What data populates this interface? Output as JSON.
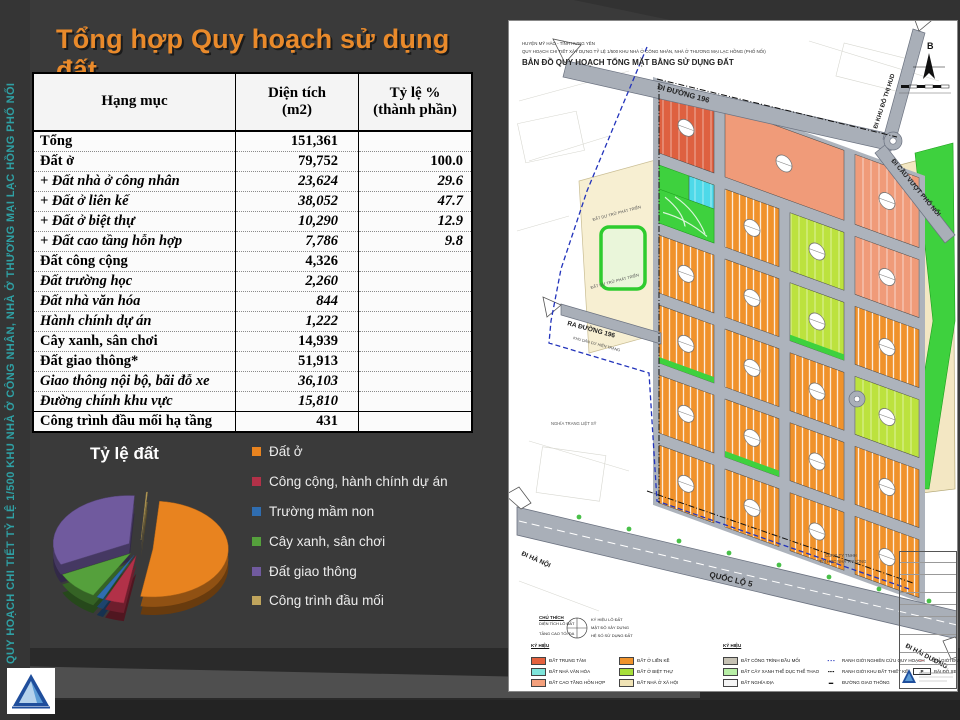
{
  "slide": {
    "title": "Tổng hợp Quy hoạch sử dụng đất",
    "sidebar_text": "QUY HOẠCH CHI TIẾT TỶ LỆ 1/500 KHU NHÀ Ở CÔNG NHÂN, NHÀ Ở THƯƠNG MẠI LẠC HỒNG PHỐ NỐI"
  },
  "table": {
    "headers": [
      {
        "line1": "Hạng mục",
        "line2": ""
      },
      {
        "line1": "Diện tích",
        "line2": "(m2)"
      },
      {
        "line1": "Tỷ lệ %",
        "line2": "(thành phần)"
      }
    ],
    "rows": [
      {
        "label": "Tổng",
        "area": "151,361",
        "pct": "",
        "style": "bold"
      },
      {
        "label": "Đất ở",
        "area": "79,752",
        "pct": "100.0",
        "style": "bold"
      },
      {
        "label": "+ Đất nhà ở công nhân",
        "area": "23,624",
        "pct": "29.6",
        "style": "sub"
      },
      {
        "label": "+ Đất ở liên kế",
        "area": "38,052",
        "pct": "47.7",
        "style": "sub"
      },
      {
        "label": "+ Đất ở biệt thự",
        "area": "10,290",
        "pct": "12.9",
        "style": "sub"
      },
      {
        "label": "+ Đất cao tầng hỗn hợp",
        "area": "7,786",
        "pct": "9.8",
        "style": "sub"
      },
      {
        "label": "Đất công cộng",
        "area": "4,326",
        "pct": "",
        "style": "bold"
      },
      {
        "label": "Đất trường học",
        "area": "2,260",
        "pct": "",
        "style": "sub"
      },
      {
        "label": "Đất nhà văn hóa",
        "area": "844",
        "pct": "",
        "style": "sub"
      },
      {
        "label": "Hành chính dự án",
        "area": "1,222",
        "pct": "",
        "style": "sub"
      },
      {
        "label": "Cây xanh, sân chơi",
        "area": "14,939",
        "pct": "",
        "style": "bold"
      },
      {
        "label": "Đất giao thông*",
        "area": "51,913",
        "pct": "",
        "style": "bold"
      },
      {
        "label": "Giao thông nội bộ, bãi đỗ xe",
        "area": "36,103",
        "pct": "",
        "style": "sub"
      },
      {
        "label": "Đường chính khu vực",
        "area": "15,810",
        "pct": "",
        "style": "sub"
      },
      {
        "label": "Công trình đầu mối hạ tầng",
        "area": "431",
        "pct": "",
        "style": "bold final"
      }
    ]
  },
  "chart_data": {
    "type": "pie",
    "style": "3d-exploded",
    "title": "Tỷ lệ đất",
    "labels": [
      "Đất ở",
      "Công cộng, hành chính dự án",
      "Trường mầm non",
      "Cây xanh, sân chơi",
      "Đất giao thông",
      "Công trình đầu mối"
    ],
    "values": [
      79752,
      6392,
      2260,
      14939,
      51913,
      431
    ],
    "colors": [
      "#E8831F",
      "#B23148",
      "#2F6DB0",
      "#55A03C",
      "#705A9E",
      "#BFA45C"
    ],
    "legend_position": "right"
  },
  "map": {
    "title_line1": "HUYỆN MỸ HÀO - TỈNH HƯNG YÊN",
    "title_line2": "QUY HOẠCH CHI TIẾT XÂY DỰNG TỶ LỆ 1/500 KHU NHÀ Ở CÔNG NHÂN, NHÀ Ở THƯƠNG MẠI LẠC HỒNG (PHỐ NỐI)",
    "title_line3": "BẢN ĐỒ QUY HOẠCH TỔNG MẶT BẰNG SỬ DỤNG ĐẤT",
    "north_label": "B",
    "roads": {
      "r196": "ĐI ĐƯỜNG 196",
      "hud": "ĐI KHU ĐÔ THỊ HUD",
      "cauvuot": "ĐI CẦU VƯỢT PHỐ NỐI",
      "ra196": "RA ĐƯỜNG 196",
      "hanoi": "ĐI HÀ NỘI",
      "ql5": "QUỐC LỘ 5",
      "haiduong": "ĐI HẢI DƯƠNG"
    },
    "areas": {
      "reserve1": "ĐẤT DỰ TRỮ PHÁT TRIỂN",
      "reserve2": "ĐẤT DỰ TRỮ PHÁT TRIỂN",
      "residential": "KHU DÂN CƯ HIỆN TRẠNG",
      "cemetery": "NGHĨA TRANG LIỆT SỸ",
      "company1": "CÔNG TY TNHH",
      "company2": "TIN HỌC NHÀ TRƯỜNG"
    },
    "note": {
      "title": "CHÚ THÍCH",
      "left": [
        "DIỆN TÍCH LÔ ĐẤT",
        "TẦNG CAO TỐI ĐA"
      ],
      "right": [
        "KÝ HIỆU LÔ ĐẤT",
        "MẬT ĐỘ XÂY DỰNG",
        "HỆ SỐ SỬ DỤNG ĐẤT"
      ]
    },
    "legend_title1": "KÝ HIỆU",
    "legend_title2": "KÝ HIỆU",
    "legend_items": [
      {
        "label": "ĐẤT TRUNG TÂM",
        "color": "#E4613E",
        "col": 0
      },
      {
        "label": "ĐẤT NHÀ VĂN HÓA",
        "color": "#7EE5DB",
        "col": 0
      },
      {
        "label": "ĐẤT CAO TẦNG HỖN HỢP",
        "color": "#F4A07C",
        "col": 0
      },
      {
        "label": "ĐẤT Ở LIỀN KỀ",
        "color": "#F0932C",
        "col": 1
      },
      {
        "label": "ĐẤT Ở BIỆT THỰ",
        "color": "#A6DE3A",
        "col": 1
      },
      {
        "label": "ĐẤT NHÀ Ở XÃ HỘI",
        "color": "#F0E3B5",
        "col": 1
      },
      {
        "label": "ĐẤT CÔNG TRÌNH ĐẦU MỐI",
        "color": "#C6C2B4",
        "col": 2
      },
      {
        "label": "ĐẤT CÂY XANH THỂ DỤC THỂ THAO",
        "color": "#B8EFA6",
        "col": 2
      },
      {
        "label": "ĐẤT NGHĨA ĐỊA",
        "color": "#F5F5F5",
        "col": 2
      }
    ],
    "symbol_items": [
      {
        "label": "RANH GIỚI NGHIÊN CỨU QUY HOẠCH",
        "sym": "▪ ▪ ▪",
        "col": 3
      },
      {
        "label": "RANH GIỚI KHU ĐẤT THIẾT KẾ",
        "sym": "▪▪▪▪",
        "col": 3
      },
      {
        "label": "ĐƯỜNG GIAO THÔNG",
        "sym": "▬",
        "col": 3
      },
      {
        "label": "CHỈ GIỚI ĐƯỜNG ĐỎ",
        "sym": "╌╌",
        "col": 4
      },
      {
        "label": "BÃI ĐỖ XE",
        "sym": "P",
        "col": 4
      }
    ]
  }
}
